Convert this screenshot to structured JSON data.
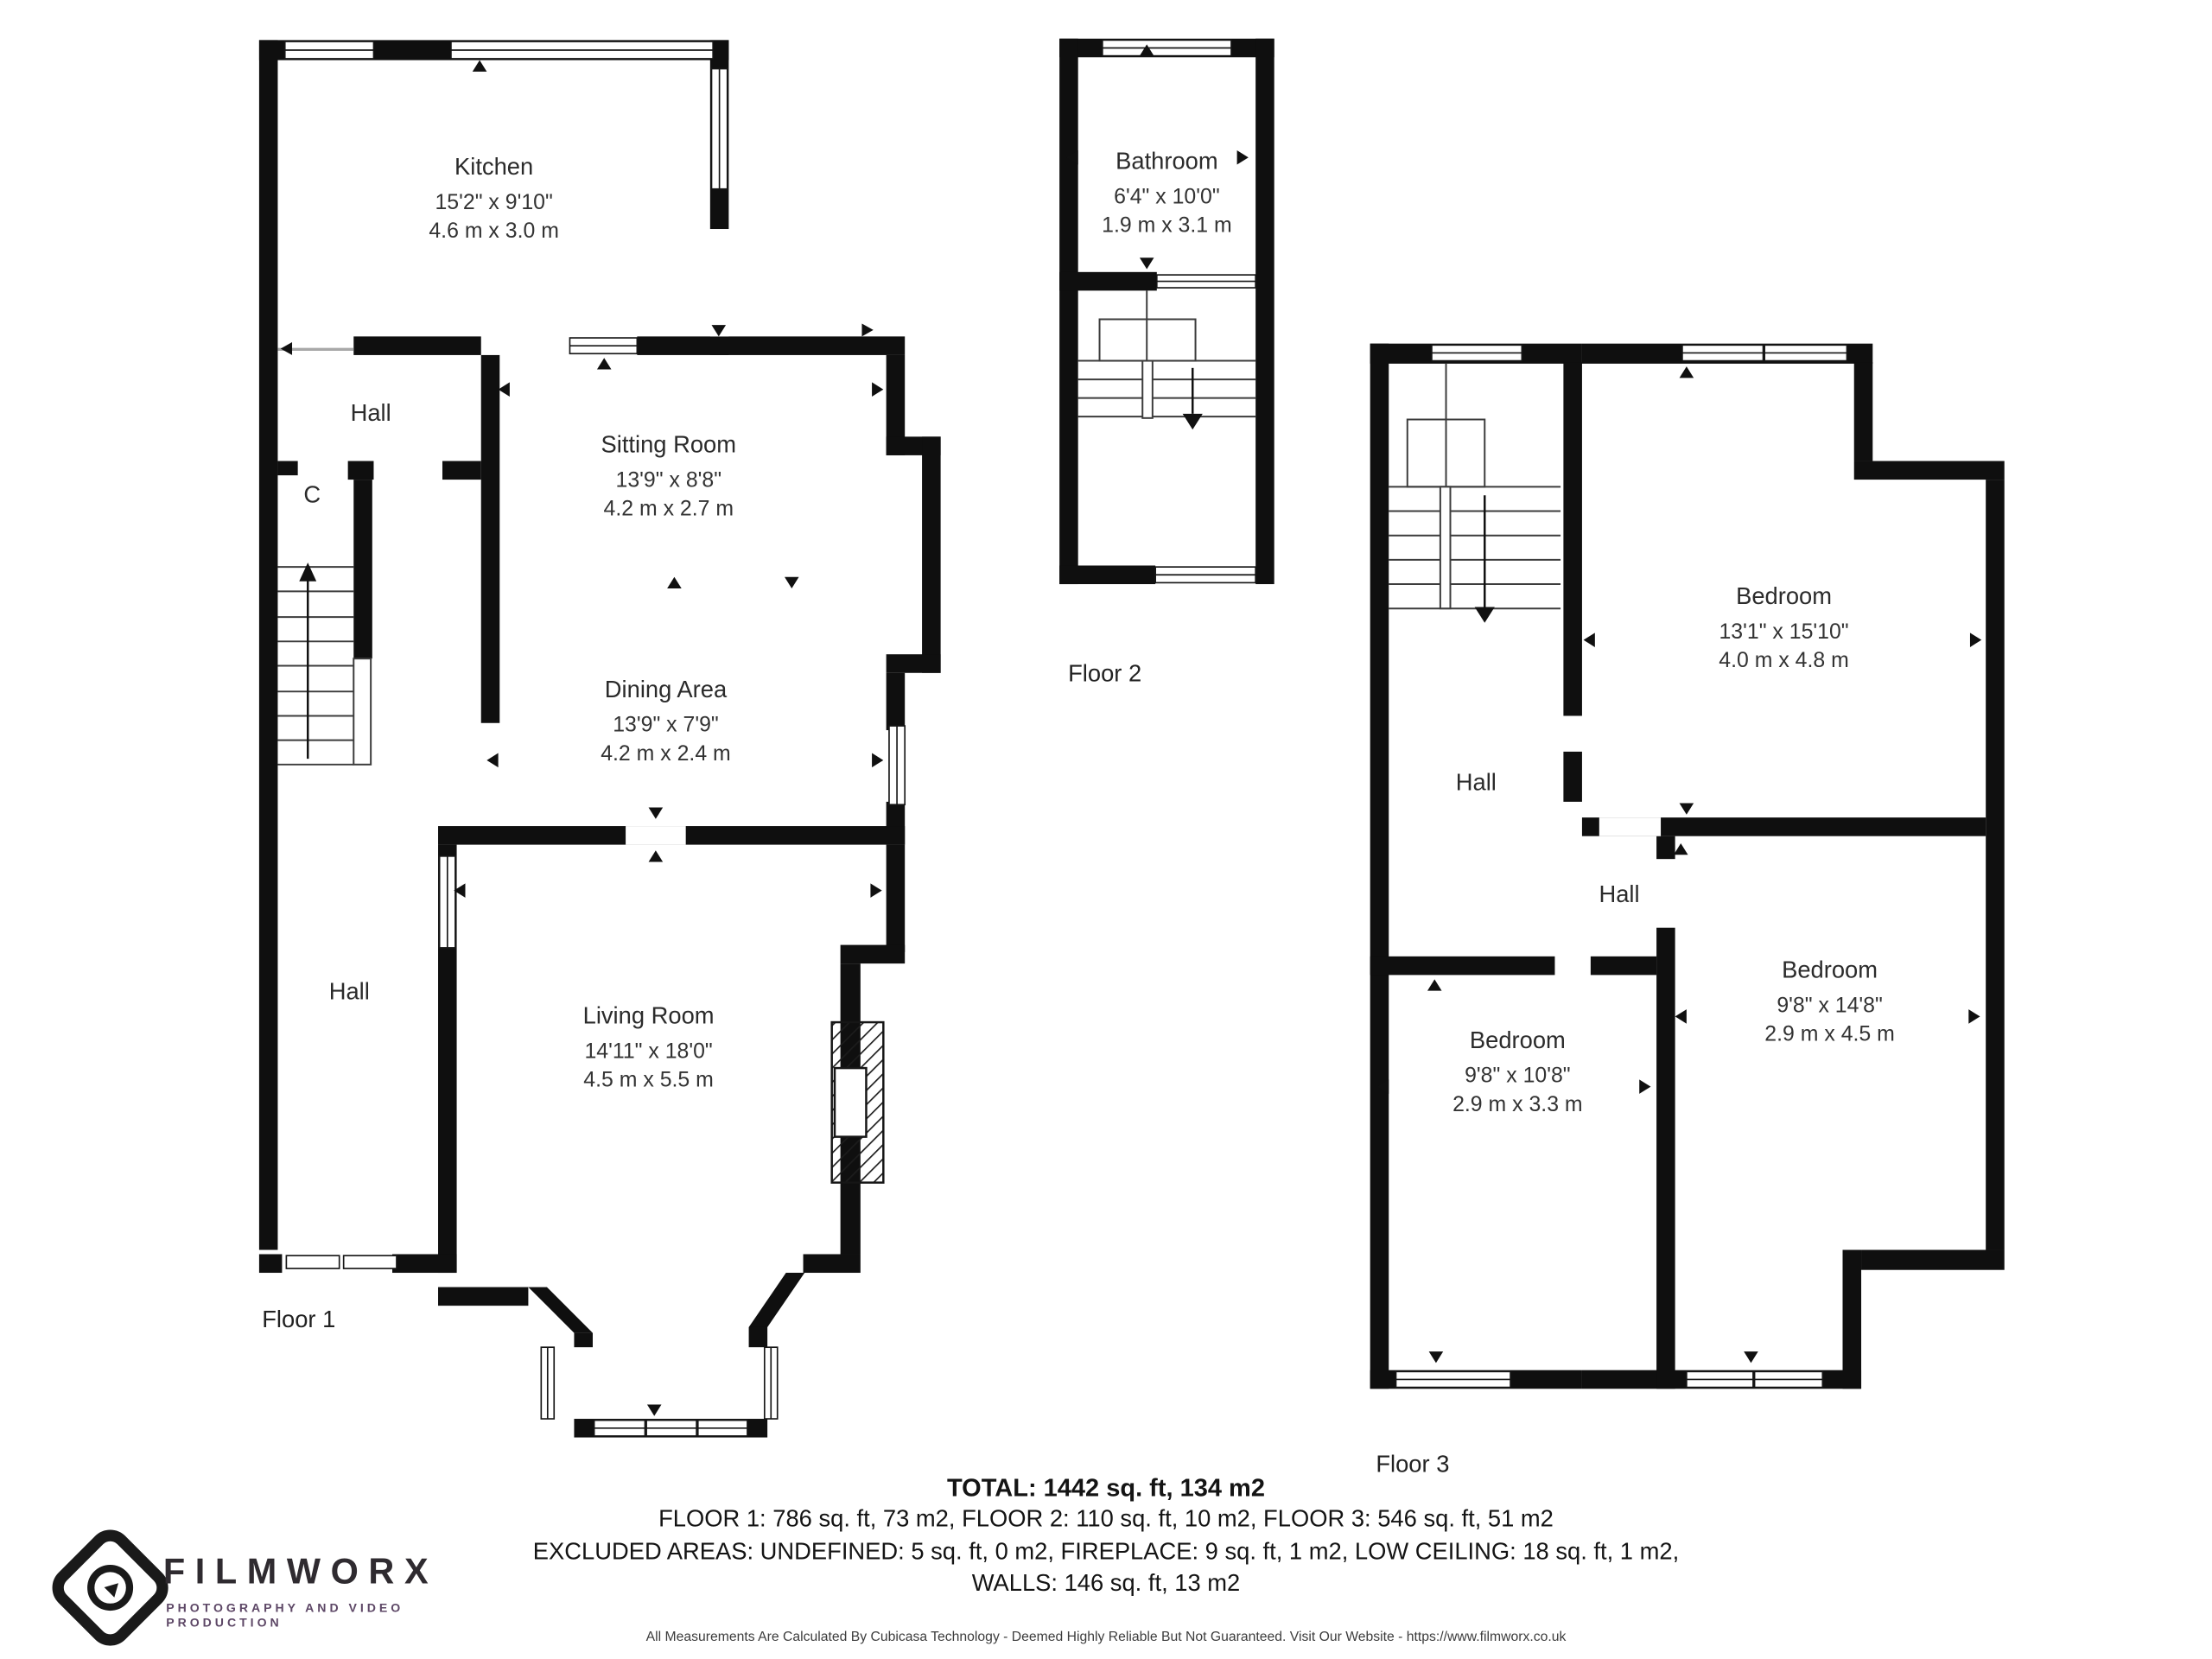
{
  "floors": [
    {
      "name": "Floor 1",
      "rooms": [
        {
          "name": "Kitchen",
          "imperial": "15'2\" x 9'10\"",
          "metric": "4.6 m x 3.0 m"
        },
        {
          "name": "Hall"
        },
        {
          "name": "C"
        },
        {
          "name": "Sitting Room",
          "imperial": "13'9\" x 8'8\"",
          "metric": "4.2 m x 2.7 m"
        },
        {
          "name": "Dining Area",
          "imperial": "13'9\" x 7'9\"",
          "metric": "4.2 m x 2.4 m"
        },
        {
          "name": "Hall"
        },
        {
          "name": "Living Room",
          "imperial": "14'11\" x 18'0\"",
          "metric": "4.5 m x 5.5 m"
        }
      ]
    },
    {
      "name": "Floor 2",
      "rooms": [
        {
          "name": "Bathroom",
          "imperial": "6'4\" x 10'0\"",
          "metric": "1.9 m x 3.1 m"
        }
      ]
    },
    {
      "name": "Floor 3",
      "rooms": [
        {
          "name": "Bedroom",
          "imperial": "13'1\" x 15'10\"",
          "metric": "4.0 m x 4.8 m"
        },
        {
          "name": "Hall"
        },
        {
          "name": "Hall"
        },
        {
          "name": "Bedroom",
          "imperial": "9'8\" x 10'8\"",
          "metric": "2.9 m x 3.3 m"
        },
        {
          "name": "Bedroom",
          "imperial": "9'8\" x 14'8\"",
          "metric": "2.9 m x 4.5 m"
        }
      ]
    }
  ],
  "summary": {
    "total": "TOTAL: 1442 sq. ft, 134 m2",
    "floors_line": "FLOOR 1: 786 sq. ft, 73 m2, FLOOR 2: 110 sq. ft, 10 m2, FLOOR 3: 546 sq. ft, 51 m2",
    "excluded_line": "EXCLUDED AREAS: UNDEFINED: 5 sq. ft, 0 m2, FIREPLACE: 9 sq. ft, 1 m2, LOW CEILING: 18 sq. ft, 1 m2,",
    "walls_line": "WALLS: 146 sq. ft, 13 m2"
  },
  "branding": {
    "name": "FILMWORX",
    "tagline": "PHOTOGRAPHY AND VIDEO PRODUCTION"
  },
  "disclaimer": "All Measurements Are Calculated By Cubicasa Technology - Deemed Highly Reliable But Not Guaranteed. Visit Our Website - https://www.filmworx.co.uk",
  "colors": {
    "wall": "#0f0f0f",
    "logo_text": "#2f2b30",
    "logo_tagline": "#5d4766"
  }
}
